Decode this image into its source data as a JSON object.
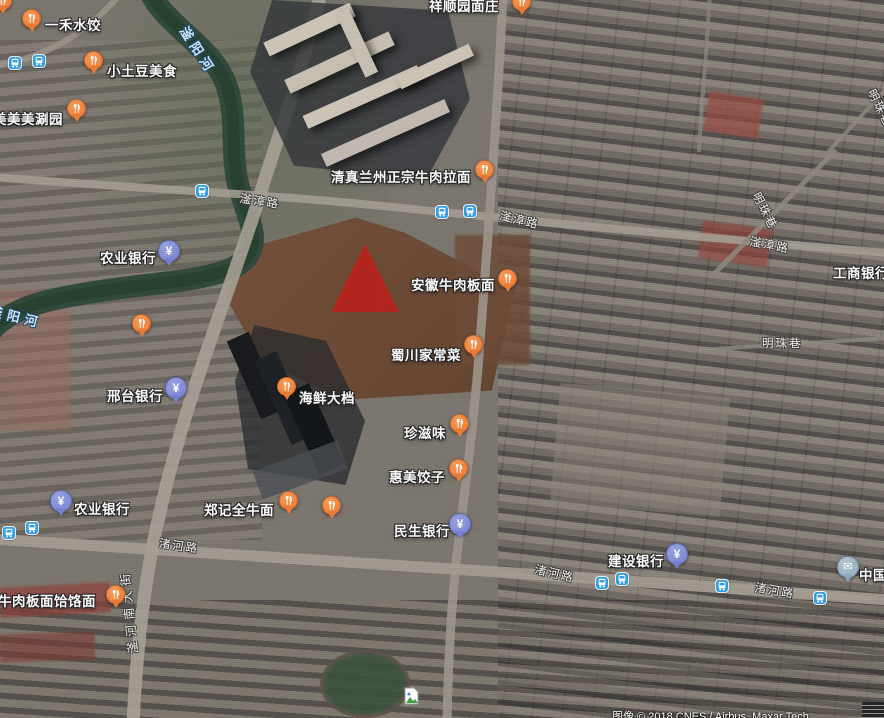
{
  "map": {
    "attribution": "图像 © 2018 CNES / Airbus, Maxar Tech",
    "colors": {
      "restaurant_pin": "#ec7b35",
      "bank_pin": "#7581d2",
      "post_pin": "#8fa9bf",
      "transit_icon": "#2f9fe8",
      "dropped_marker": "#b4241b",
      "water_label": "#cfe6f7"
    },
    "marker": {
      "x": 331,
      "y": 244,
      "color": "#b4241b"
    },
    "pois": [
      {
        "label": "祥顺园面庄",
        "type": "restaurant",
        "pin": {
          "x": 512,
          "y": -8
        },
        "label_pos": {
          "x": 429,
          "y": -5
        }
      },
      {
        "label": "一禾水饺",
        "type": "restaurant",
        "pin": {
          "x": 22,
          "y": 9
        },
        "label_pos": {
          "x": 45,
          "y": 14
        }
      },
      {
        "label": "小土豆美食",
        "type": "restaurant",
        "pin": {
          "x": 84,
          "y": 51
        },
        "label_pos": {
          "x": 107,
          "y": 60
        }
      },
      {
        "label": "美美美涮园",
        "type": "restaurant",
        "pin": {
          "x": 67,
          "y": 99
        },
        "label_pos": {
          "x": -7,
          "y": 108
        }
      },
      {
        "label": "清真兰州正宗牛肉拉面",
        "type": "restaurant",
        "pin": {
          "x": 475,
          "y": 160
        },
        "label_pos": {
          "x": 331,
          "y": 166
        }
      },
      {
        "label": "安徽牛肉板面",
        "type": "restaurant",
        "pin": {
          "x": 498,
          "y": 269
        },
        "label_pos": {
          "x": 411,
          "y": 274
        }
      },
      {
        "label": "蜀川家常菜",
        "type": "restaurant",
        "pin": {
          "x": 464,
          "y": 335
        },
        "label_pos": {
          "x": 391,
          "y": 344
        }
      },
      {
        "label": "农业银行",
        "type": "bank",
        "pin": {
          "x": 158,
          "y": 240
        },
        "label_pos": {
          "x": 100,
          "y": 247
        }
      },
      {
        "label": "邢台银行",
        "type": "bank",
        "pin": {
          "x": 165,
          "y": 377
        },
        "label_pos": {
          "x": 107,
          "y": 385
        }
      },
      {
        "label": "海鲜大档",
        "type": "restaurant",
        "pin": {
          "x": 277,
          "y": 377
        },
        "label_pos": {
          "x": 299,
          "y": 387
        }
      },
      {
        "label": "珍滋味",
        "type": "restaurant",
        "pin": {
          "x": 450,
          "y": 414
        },
        "label_pos": {
          "x": 404,
          "y": 422
        }
      },
      {
        "label": "惠美饺子",
        "type": "restaurant",
        "pin": {
          "x": 449,
          "y": 459
        },
        "label_pos": {
          "x": 389,
          "y": 466
        }
      },
      {
        "label": "郑记全牛面",
        "type": "restaurant",
        "pin": {
          "x": 279,
          "y": 491
        },
        "label_pos": {
          "x": 204,
          "y": 499
        }
      },
      {
        "label": "",
        "type": "restaurant",
        "pin": {
          "x": 322,
          "y": 496
        },
        "label_pos": null
      },
      {
        "label": "民生银行",
        "type": "bank",
        "pin": {
          "x": 449,
          "y": 513
        },
        "label_pos": {
          "x": 394,
          "y": 520
        }
      },
      {
        "label": "农业银行",
        "type": "bank",
        "pin": {
          "x": 50,
          "y": 490
        },
        "label_pos": {
          "x": 74,
          "y": 498
        }
      },
      {
        "label": "徽牛肉板面饸饹面",
        "type": "restaurant",
        "pin": {
          "x": 106,
          "y": 585
        },
        "label_pos": {
          "x": -16,
          "y": 590
        }
      },
      {
        "label": "建设银行",
        "type": "bank",
        "pin": {
          "x": 666,
          "y": 543
        },
        "label_pos": {
          "x": 608,
          "y": 550
        }
      },
      {
        "label": "中国邮政",
        "type": "post",
        "pin": {
          "x": 837,
          "y": 556
        },
        "label_pos": {
          "x": 859,
          "y": 564
        }
      },
      {
        "label": "工商银行",
        "type": "bank",
        "pin": null,
        "label_pos": {
          "x": 833,
          "y": 262
        }
      },
      {
        "label": "",
        "type": "restaurant",
        "pin": {
          "x": 132,
          "y": 314
        },
        "label_pos": null
      },
      {
        "label": "",
        "type": "restaurant",
        "pin": {
          "x": -7,
          "y": -9
        },
        "label_pos": null
      }
    ],
    "transit_stops": [
      {
        "x": 9,
        "y": 57
      },
      {
        "x": 33,
        "y": 55
      },
      {
        "x": 196,
        "y": 185
      },
      {
        "x": 436,
        "y": 206
      },
      {
        "x": 464,
        "y": 205
      },
      {
        "x": 3,
        "y": 527
      },
      {
        "x": 26,
        "y": 522
      },
      {
        "x": 596,
        "y": 577
      },
      {
        "x": 616,
        "y": 573
      },
      {
        "x": 716,
        "y": 580
      },
      {
        "x": 814,
        "y": 592
      }
    ],
    "road_labels": [
      {
        "text": "滏漳路",
        "x": 240,
        "y": 190,
        "rot": 9
      },
      {
        "text": "滏漳路",
        "x": 500,
        "y": 207,
        "rot": 14
      },
      {
        "text": "滏漳路",
        "x": 750,
        "y": 233,
        "rot": 11
      },
      {
        "text": "明珠巷",
        "x": 756,
        "y": 185,
        "rot": 63
      },
      {
        "text": "明珠巷",
        "x": 762,
        "y": 335,
        "rot": 0
      },
      {
        "text": "明珠巷",
        "x": 871,
        "y": 82,
        "rot": 63
      },
      {
        "text": "渚河路",
        "x": 159,
        "y": 535,
        "rot": 8
      },
      {
        "text": "渚河路",
        "x": 535,
        "y": 561,
        "rot": 13
      },
      {
        "text": "渚河路",
        "x": 755,
        "y": 579,
        "rot": 10
      },
      {
        "text": "滏河南大街",
        "x": 133,
        "y": 645,
        "rot": -96,
        "v": true
      }
    ],
    "water_labels": [
      {
        "text": "滏阳河",
        "x": 184,
        "y": 18,
        "rot": 57
      },
      {
        "text": "滏阳河",
        "x": -10,
        "y": 300,
        "rot": 14
      }
    ]
  }
}
